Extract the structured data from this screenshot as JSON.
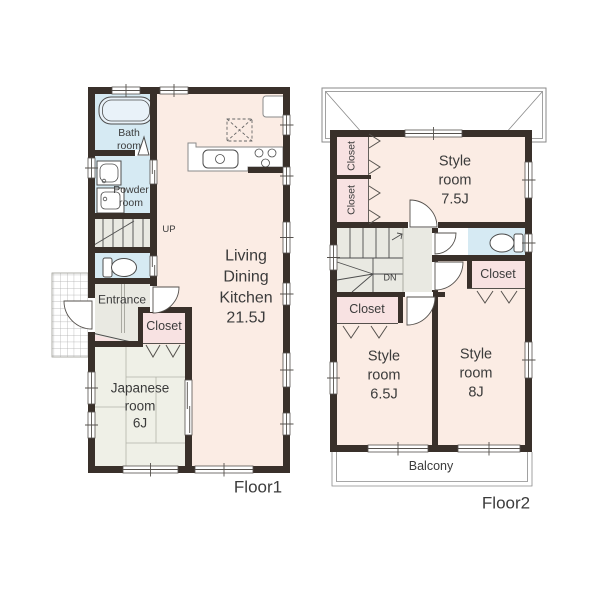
{
  "colors": {
    "wall": "#39302a",
    "room_cream": "#fbece4",
    "room_blue": "#d6eaf3",
    "room_grey": "#e9e9e2",
    "room_tatami": "#eff0e7",
    "closet_pink": "#f8e2e2",
    "text": "#3b3b3b"
  },
  "floor1": {
    "name": "Floor1",
    "bath": "Bath\nroom",
    "powder": "Powder\nroom",
    "stairs_up": "UP",
    "entrance": "Entrance",
    "closet": "Closet",
    "japanese_room": "Japanese\nroom\n6J",
    "ldk": "Living\nDining\nKitchen\n21.5J"
  },
  "floor2": {
    "name": "Floor2",
    "closet_top_1": "Closet",
    "closet_top_2": "Closet",
    "style_room_75": "Style\nroom\n7.5J",
    "stairs_down": "DN",
    "closet_mid_right": "Closet",
    "closet_mid_left": "Closet",
    "style_room_65": "Style\nroom\n6.5J",
    "style_room_8": "Style\nroom\n8J",
    "balcony": "Balcony"
  }
}
